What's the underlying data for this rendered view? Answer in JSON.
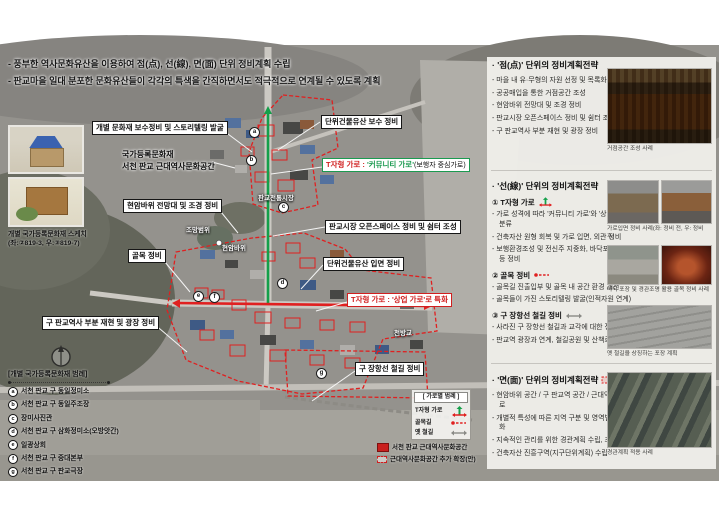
{
  "colors": {
    "boundary_red": "#e02020",
    "street_green": "#14a04a",
    "street_red": "#e02020",
    "callout_green": "#1b9a50",
    "callout_red": "#d01f1f"
  },
  "header": {
    "line1": "- 풍부한 역사문화유산을 이용하여 점(点), 선(線), 면(面) 단위 정비계획 수립",
    "line2": "- 판교마을 일대 분포한 문화유산들이 각각의 특색을 간직하면서도 적극적으로 연계될 수 있도록 계획"
  },
  "map": {
    "callouts": {
      "heritage_repair": "개별 문화재 보수정비 및 스토리텔링 발굴",
      "registered_line1": "국가등록문화재",
      "registered_line2": "서천 판교 근대역사문화공간",
      "rock_viewpoint": "현암바위 전망대 및 조경 정비",
      "alley": "골목 정비",
      "station_plaza": "구 판교역사 부분 재현 및 광장 정비",
      "unit_repair": "단위건물유산 보수 정비",
      "t_community_prefix": "T자형 가로 : ",
      "t_community_main": "'커뮤니티 가로'",
      "t_community_suffix": "(보행자 중심가로)",
      "market_openspace": "판교시장 오픈스페이스 정비 및 쉼터 조성",
      "unit_facade": "단위건물유산 입면 정비",
      "t_commercial_prefix": "T자형 가로 : ",
      "t_commercial_main": "'상업 가로'로 특화",
      "rail_repair": "구 장항선 철길 정비"
    },
    "labels": {
      "market": "판교전통시장",
      "view_range": "조망범위",
      "rock": "현암바위",
      "bridge": "천방교"
    },
    "markers": [
      "a",
      "b",
      "c",
      "d",
      "e",
      "f",
      "g"
    ],
    "street_legend": {
      "title": "[ 가로별 범례 ]",
      "t_street": "T자형 가로",
      "alley": "골목길",
      "old_rail": "옛 철길",
      "zone_core": "서천 판교 근대역사문화공간",
      "zone_ext": "근대역사문화공간 추가 확장(안)"
    },
    "heritage_legend": {
      "title": "[개별 국가등록문화재 범례]",
      "items": [
        {
          "marker": "a",
          "label": "서천 판교 구 동일정미소"
        },
        {
          "marker": "b",
          "label": "서천 판교 구 동일주조장"
        },
        {
          "marker": "c",
          "label": "장미사진관"
        },
        {
          "marker": "d",
          "label": "서천 판교 구 삼화정미소(오방앗간)"
        },
        {
          "marker": "e",
          "label": "일광상회"
        },
        {
          "marker": "f",
          "label": "서천 판교 구 중대본부"
        },
        {
          "marker": "g",
          "label": "서천 판교 구 판교극장"
        }
      ]
    },
    "sketch_caption_line1": "개별 국가등록문화재 스케치",
    "sketch_caption_line2": "(좌:②819-3, 우:③819-7)"
  },
  "sidebar": {
    "sections": [
      {
        "title": "· '점(点)' 단위의 정비계획전략",
        "items": [
          "- 마을 내 유·무형의 자원 선정 및 목록화",
          "- 공공매입을 통한 거점공간 조성",
          "- 현암바위 전망대 및 조경 정비",
          "- 판교시장 오픈스페이스 정비 및 쉼터 조성",
          "- 구 판교역사 부분 재현 및 광장 정비"
        ]
      },
      {
        "title": "· '선(線)' 단위의 정비계획전략",
        "subs": [
          {
            "head": "① T자형 가로",
            "items": [
              "- 가로 성격에 따라 '커뮤니티 가로'와 '상업가로'로 분류",
              "- 건축자산 원형 회복 및 가로 입면, 외관 정비",
              "- 보행환경조성 및 전신주 지중화, 바닥포장, 가로등 등 정비"
            ]
          },
          {
            "head": "② 골목 정비",
            "items": [
              "- 골목길 진출입부 및 골목 내 공간 환경 개선",
              "- 골목들이 가진 스토리텔링 발굴(인적자원 연계)"
            ]
          },
          {
            "head": "③ 구 장항선 철길 정비",
            "items": [
              "- 사라진 구 장항선 철길과 교각에 대한 정비",
              "- 판교역 광장과 연계, 철길공원 및 산책로 조성"
            ]
          }
        ]
      },
      {
        "title": "· '면(面)' 단위의 정비계획전략",
        "items": [
          "- 현암바위 공간 / 구 판교역 공간 / 근대역사문화가로",
          "- 개별적 특성에 따른 지역 구분 및 영역별 콘셉 강화",
          "- 지속적인 관리를 위한 경관계획 수립, 조례 마련",
          "- 건축자산 진흥구역(지구단위계획) 수립"
        ]
      }
    ],
    "photos": [
      {
        "caption": "거점공간 조성 사례"
      },
      {
        "caption": "가로입면 정비 사례(좌: 정비 전, 우: 정비 후)"
      },
      {
        "caption": "바닥 포장 및 경관조명 활용 골목 정비 사례"
      },
      {
        "caption": "옛 철길을 상징하는 포장 계획"
      },
      {
        "caption": "경관계획 적용 사례"
      }
    ]
  }
}
